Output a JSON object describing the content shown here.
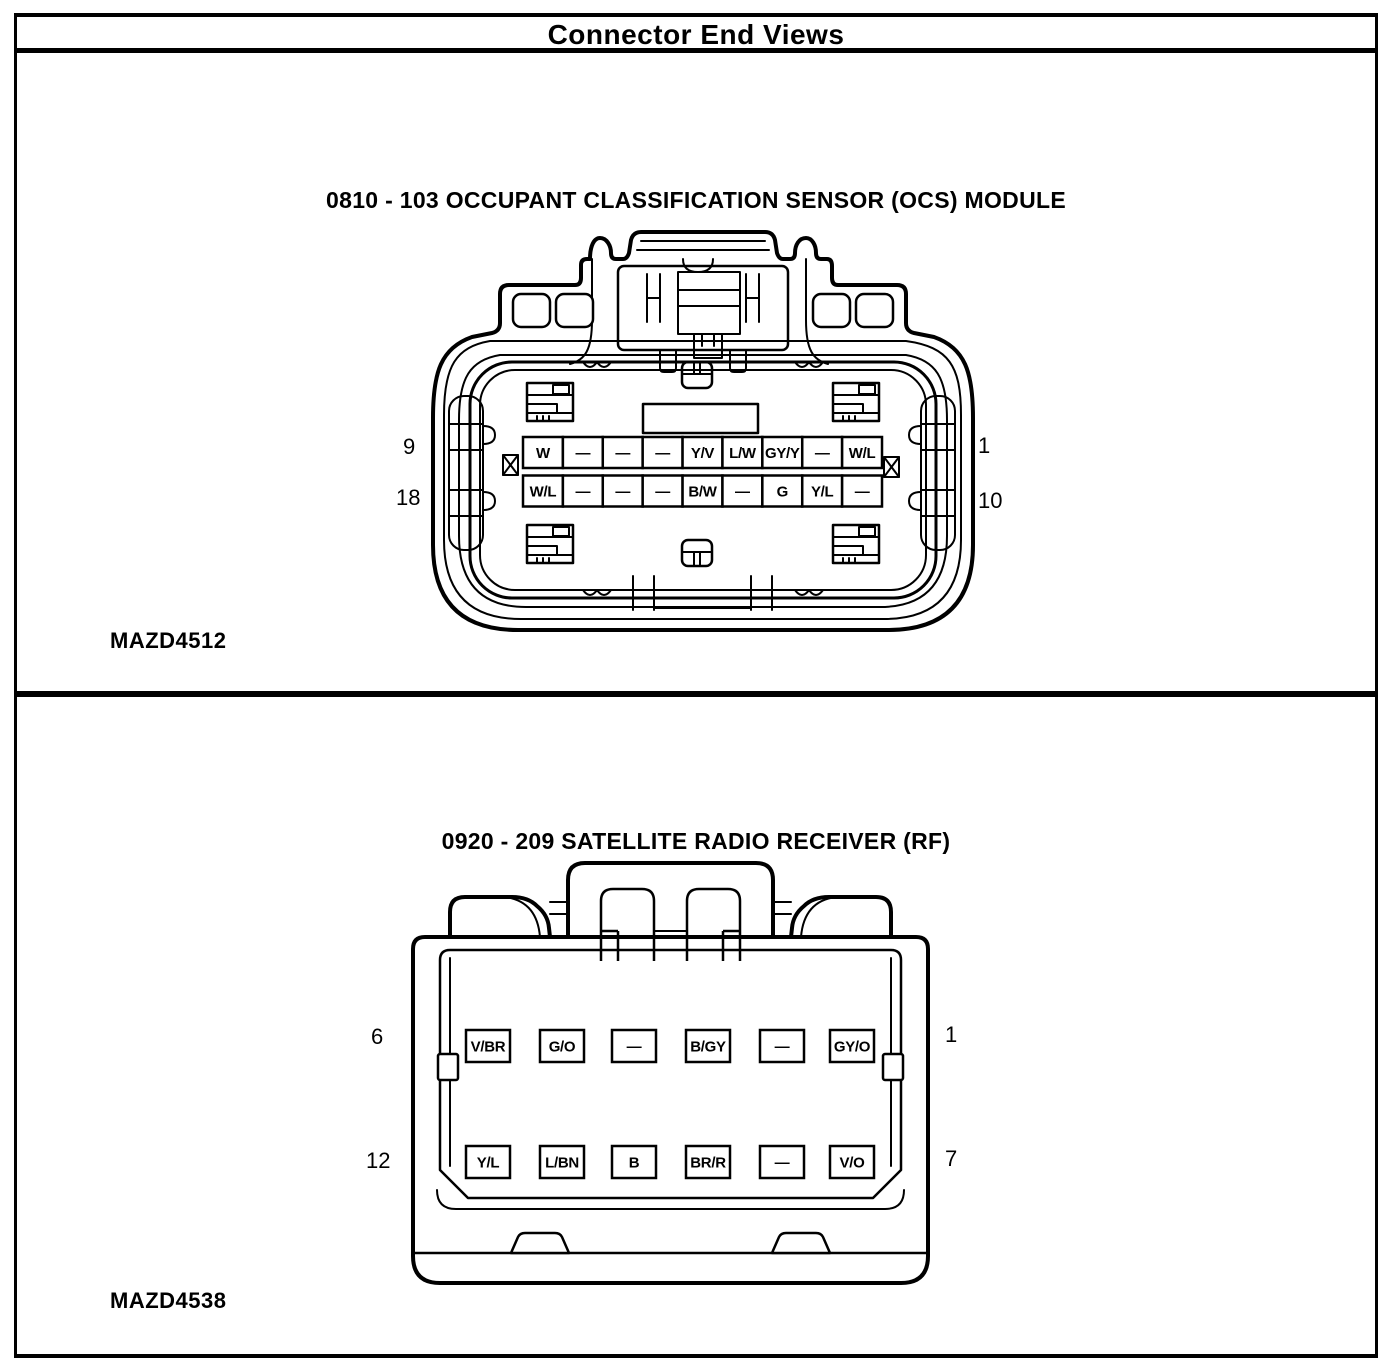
{
  "header": {
    "title": "Connector End Views"
  },
  "connectors": [
    {
      "title": "0810 - 103 OCCUPANT CLASSIFICATION SENSOR (OCS) MODULE",
      "figure_label": "MAZD4512",
      "pin_numbers": {
        "top_left": "9",
        "bottom_left": "18",
        "top_right": "1",
        "bottom_right": "10"
      },
      "pin_rows": [
        [
          "W",
          "—",
          "—",
          "—",
          "Y/V",
          "L/W",
          "GY/Y",
          "—",
          "W/L"
        ],
        [
          "W/L",
          "—",
          "—",
          "—",
          "B/W",
          "—",
          "G",
          "Y/L",
          "—"
        ]
      ]
    },
    {
      "title": "0920 - 209 SATELLITE RADIO RECEIVER (RF)",
      "figure_label": "MAZD4538",
      "pin_numbers": {
        "top_left": "6",
        "bottom_left": "12",
        "top_right": "1",
        "bottom_right": "7"
      },
      "pin_rows": [
        [
          "V/BR",
          "G/O",
          "—",
          "B/GY",
          "—",
          "GY/O"
        ],
        [
          "Y/L",
          "L/BN",
          "B",
          "BR/R",
          "—",
          "V/O"
        ]
      ]
    }
  ],
  "colors": {
    "ink": "#000000",
    "paper": "#ffffff"
  }
}
